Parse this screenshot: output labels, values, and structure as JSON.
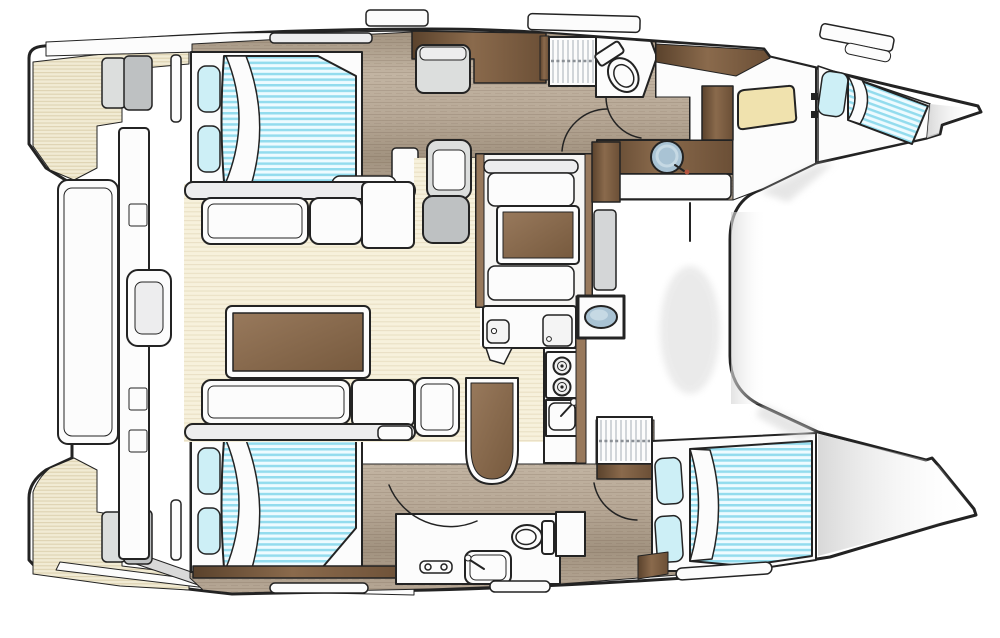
{
  "diagram": {
    "type": "floor-plan",
    "subject": "Catamaran yacht interior deck plan, overhead view, bows pointing right",
    "visible_text": [],
    "legend": "none"
  },
  "colors": {
    "outline": "#232323",
    "hull-fill": "#ffffff",
    "deck-base": "#f1ebd4",
    "deck-line": "#ddd2b1",
    "salon-base": "#f7f1dc",
    "salon-line": "#e9e0c4",
    "wood-1": "#b7a896",
    "wood-2": "#a1927f",
    "wood-3": "#c2b4a2",
    "walnut-1": "#5a422c",
    "walnut-2": "#8a6a4c",
    "walnut-3": "#6b4f36",
    "table-1": "#98795c",
    "table-2": "#775a3e",
    "mattress-base": "#eefbff",
    "mattress-stripe": "#93dcee",
    "pillow": "#cdeff6",
    "seat-light": "#dcdedd",
    "seat-gray": "#bec1c2",
    "panel-gray": "#d4d6d7",
    "furniture-white": "#fcfcfc",
    "furniture-shade": "#ededee",
    "basin": "#a9c3d4",
    "basin-hi": "#c6d9e4",
    "pad-yellow": "#f0e2ae",
    "stripe-gray": "#c6cbd0",
    "step-gray": "#d9d9d9",
    "shadow": "#d6d6d6",
    "accent-dot": "#b5543f"
  },
  "inventory": {
    "hulls": [
      "port-hull-top",
      "starboard-hull-bottom"
    ],
    "rooms": [
      {
        "id": "port-aft-cabin",
        "features": [
          "double-berth",
          "pillows",
          "hatch"
        ]
      },
      {
        "id": "port-head",
        "features": [
          "shower",
          "toilet",
          "washbasin-round",
          "vanity"
        ]
      },
      {
        "id": "port-forward-cabin",
        "features": [
          "single-berth",
          "desk-pad",
          "wardrobe"
        ]
      },
      {
        "id": "starboard-aft-cabin",
        "features": [
          "double-berth",
          "pillows"
        ]
      },
      {
        "id": "starboard-head",
        "features": [
          "toilet",
          "washbasin",
          "shower-mixer",
          "shower-grate"
        ]
      },
      {
        "id": "starboard-forward-cabin",
        "features": [
          "double-berth",
          "pillows"
        ]
      },
      {
        "id": "salon",
        "features": [
          "l-sofa",
          "dining-table",
          "folding-table",
          "bench"
        ]
      },
      {
        "id": "nav-station",
        "features": [
          "chart-table",
          "facing-benches",
          "nav-seat"
        ]
      },
      {
        "id": "galley",
        "features": [
          "twin-sinks",
          "two-burner-stove",
          "sink-with-faucet",
          "oval-basin-unit"
        ]
      },
      {
        "id": "cockpit",
        "features": [
          "teak-deck",
          "bench",
          "sliding-door",
          "corner-seats",
          "transom-steps"
        ]
      },
      {
        "id": "foredeck",
        "features": [
          "open-deck-between-bows"
        ]
      }
    ],
    "counts": {
      "berths": 4,
      "heads": 2,
      "tables": 4,
      "sinks": 6,
      "toilets": 2,
      "showers": 3
    }
  }
}
